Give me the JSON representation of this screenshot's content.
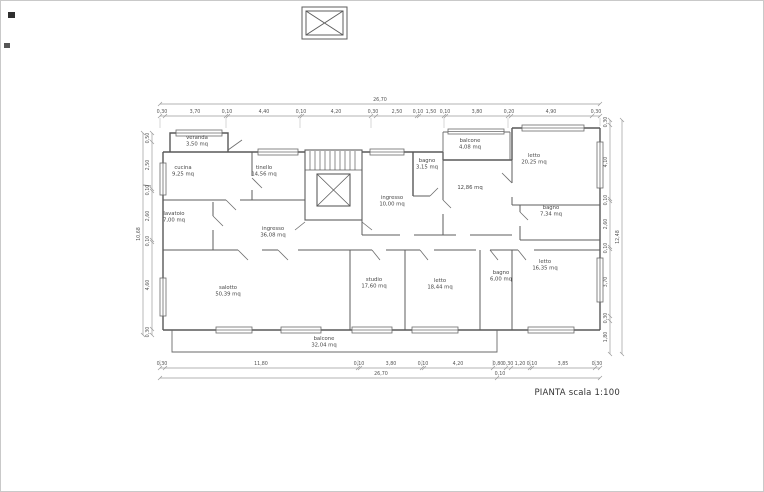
{
  "title": {
    "label": "PIANTA scala 1:100"
  },
  "plan": {
    "rooms": [
      {
        "name": "veranda",
        "area": "3,50 mq",
        "x": 197,
        "y": 139
      },
      {
        "name": "cucina",
        "area": "9,25 mq",
        "x": 183,
        "y": 169
      },
      {
        "name": "tinello",
        "area": "14,56 mq",
        "x": 264,
        "y": 169
      },
      {
        "name": "lavatoio",
        "area": "7,00 mq",
        "x": 174,
        "y": 215
      },
      {
        "name": "ingresso",
        "area": "36,08 mq",
        "x": 273,
        "y": 230
      },
      {
        "name": "salotto",
        "area": "50,39 mq",
        "x": 228,
        "y": 289
      },
      {
        "name": "balcone",
        "area": "32,04 mq",
        "x": 324,
        "y": 340
      },
      {
        "name": "studio",
        "area": "17,60 mq",
        "x": 374,
        "y": 281
      },
      {
        "name": "letto",
        "area": "18,44 mq",
        "x": 440,
        "y": 282
      },
      {
        "name": "bagno",
        "area": "6,00 mq",
        "x": 501,
        "y": 274
      },
      {
        "name": "letto",
        "area": "16,35 mq",
        "x": 545,
        "y": 263
      },
      {
        "name": "bagno",
        "area": "7,34 mq",
        "x": 551,
        "y": 209
      },
      {
        "name": "letto",
        "area": "20,25 mq",
        "x": 534,
        "y": 157
      },
      {
        "name": "",
        "area": "12,86 mq",
        "x": 470,
        "y": 186
      },
      {
        "name": "bagno",
        "area": "3,15 mq",
        "x": 427,
        "y": 162
      },
      {
        "name": "balcone",
        "area": "4,08 mq",
        "x": 470,
        "y": 142
      },
      {
        "name": "ingresso",
        "area": "10,00 mq",
        "x": 392,
        "y": 199
      }
    ],
    "dims": {
      "top_total": {
        "t": "26,70",
        "x": 380,
        "y": 101
      },
      "top": [
        {
          "t": "0,30",
          "x": 162
        },
        {
          "t": "3,70",
          "x": 195
        },
        {
          "t": "0,10",
          "x": 227
        },
        {
          "t": "4,40",
          "x": 264
        },
        {
          "t": "0,10",
          "x": 301
        },
        {
          "t": "4,20",
          "x": 336
        },
        {
          "t": "0,30",
          "x": 373
        },
        {
          "t": "2,50",
          "x": 397
        },
        {
          "t": "0,10",
          "x": 418
        },
        {
          "t": "1,50",
          "x": 431
        },
        {
          "t": "0,10",
          "x": 445
        },
        {
          "t": "3,80",
          "x": 477
        },
        {
          "t": "0,20",
          "x": 509
        },
        {
          "t": "4,90",
          "x": 551
        },
        {
          "t": "0,30",
          "x": 596
        }
      ],
      "bottom": [
        {
          "t": "0,30",
          "x": 162
        },
        {
          "t": "11,80",
          "x": 261
        },
        {
          "t": "0,10",
          "x": 359
        },
        {
          "t": "3,80",
          "x": 391
        },
        {
          "t": "0,10",
          "x": 423
        },
        {
          "t": "4,20",
          "x": 458
        },
        {
          "t": "0,80",
          "x": 498
        },
        {
          "t": "0,30",
          "x": 508
        },
        {
          "t": "1,20",
          "x": 520
        },
        {
          "t": "0,10",
          "x": 532
        },
        {
          "t": "3,85",
          "x": 563
        },
        {
          "t": "0,30",
          "x": 597
        }
      ],
      "bottom_extra": [
        {
          "t": "26,70",
          "x": 381,
          "y": 375
        },
        {
          "t": "0,10",
          "x": 500,
          "y": 375
        }
      ],
      "left": [
        {
          "t": "0,50",
          "y": 138
        },
        {
          "t": "2,50",
          "y": 165
        },
        {
          "t": "0,10",
          "y": 190
        },
        {
          "t": "2,60",
          "y": 216
        },
        {
          "t": "0,10",
          "y": 241
        },
        {
          "t": "4,60",
          "y": 285
        },
        {
          "t": "0,30",
          "y": 332
        }
      ],
      "left_total": {
        "t": "10,68",
        "y": 234
      },
      "right": [
        {
          "t": "0,30",
          "y": 122
        },
        {
          "t": "4,10",
          "y": 162
        },
        {
          "t": "0,10",
          "y": 200
        },
        {
          "t": "2,60",
          "y": 224
        },
        {
          "t": "0,10",
          "y": 248
        },
        {
          "t": "3,70",
          "y": 282
        },
        {
          "t": "0,30",
          "y": 318
        },
        {
          "t": "1,80",
          "y": 337
        }
      ],
      "right_total": {
        "t": "12,48",
        "y": 237
      }
    }
  }
}
